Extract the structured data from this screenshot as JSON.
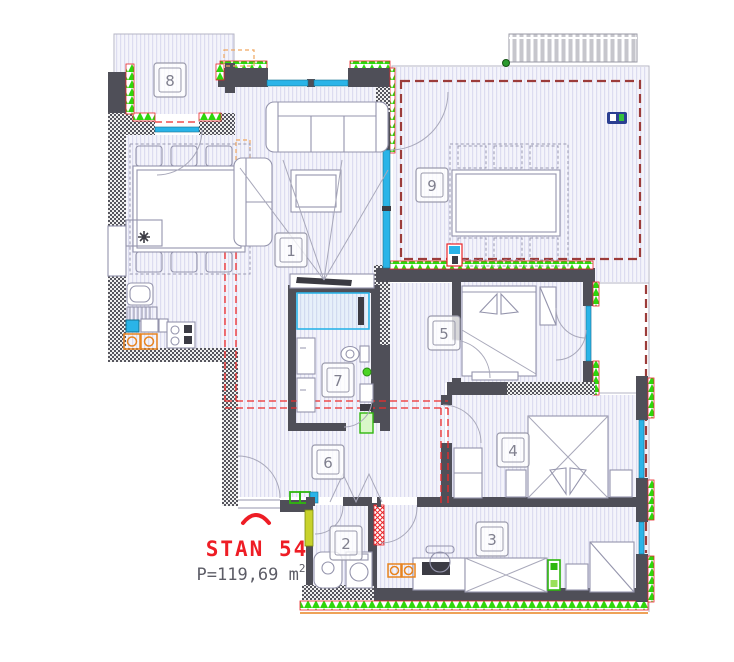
{
  "plan": {
    "apartment_label": "STAN 54",
    "area_label": "P=119,69 m",
    "area_exponent": "2"
  },
  "rooms": [
    {
      "num": "1",
      "name": "living-room",
      "cx": 291,
      "cy": 250
    },
    {
      "num": "2",
      "name": "toilet",
      "cx": 346,
      "cy": 543
    },
    {
      "num": "3",
      "name": "bedroom-3",
      "cx": 492,
      "cy": 539
    },
    {
      "num": "4",
      "name": "bedroom-4",
      "cx": 513,
      "cy": 450
    },
    {
      "num": "5",
      "name": "bedroom-5",
      "cx": 444,
      "cy": 333
    },
    {
      "num": "6",
      "name": "hallway",
      "cx": 328,
      "cy": 462
    },
    {
      "num": "7",
      "name": "bathroom",
      "cx": 338,
      "cy": 380
    },
    {
      "num": "8",
      "name": "balcony",
      "cx": 170,
      "cy": 80
    },
    {
      "num": "9",
      "name": "terrace",
      "cx": 432,
      "cy": 185
    }
  ],
  "colors": {
    "wall": "#4f4f58",
    "insulation_green": "#2ed60c",
    "window_cyan": "#2ab4e8",
    "projection_red": "#ee2a2a",
    "terrace_border": "#9c3c3a",
    "accent_orange": "#e88420",
    "label_red": "#ee1d25",
    "area_text": "#5c5c66",
    "floor_stripe": "#dcdcf0"
  }
}
